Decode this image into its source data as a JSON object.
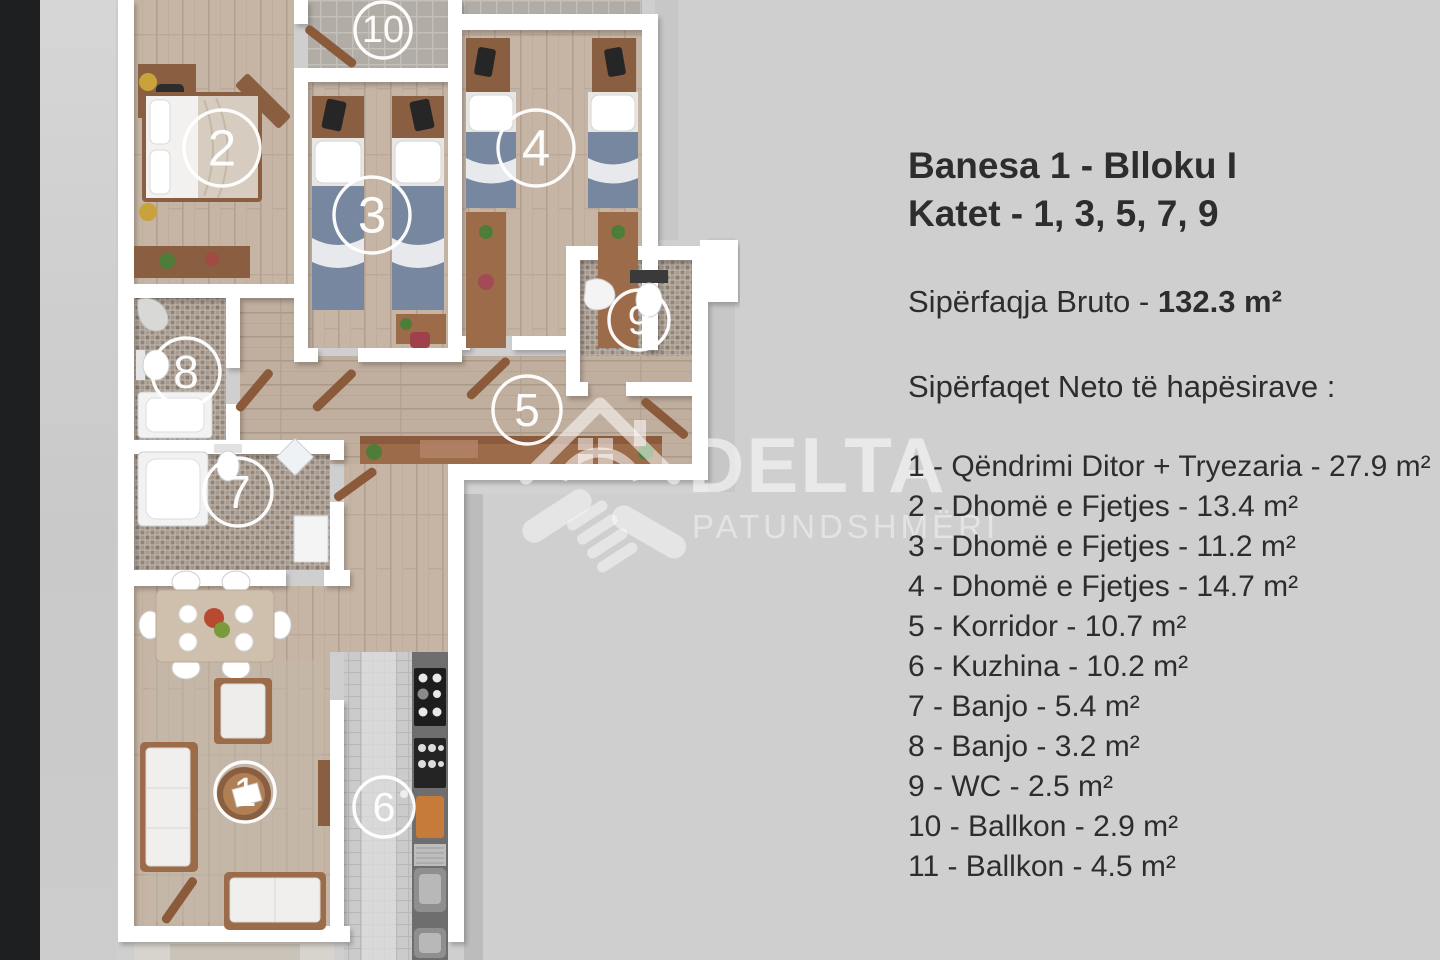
{
  "colors": {
    "background_top": "#ebebeb",
    "background_bottom": "#d8d8d8",
    "left_bar": "#1e1f20",
    "wall": "#ffffff",
    "wood_floor": "#c6b5a5",
    "bed_duvet_blue": "#76879f",
    "furniture_wood": "#8a5f41",
    "mosaic_tile": "#9b8d82",
    "kitchen_counter": "#6e6e6e",
    "panel_text": "#2d2d2d",
    "watermark": "#ffffff"
  },
  "info_panel": {
    "title_line1": "Banesa 1 - Blloku I",
    "title_line2": "Katet - 1, 3, 5, 7, 9",
    "gross_label": "Sipërfaqja Bruto - ",
    "gross_value": "132.3 m²",
    "net_heading": "Sipërfaqet Neto të hapësirave :",
    "separator": " - ",
    "rooms": [
      {
        "no": "1",
        "name": "Qëndrimi Ditor + Tryezaria",
        "area": "27.9 m²"
      },
      {
        "no": "2",
        "name": "Dhomë e Fjetjes",
        "area": "13.4 m²"
      },
      {
        "no": "3",
        "name": "Dhomë e Fjetjes",
        "area": "11.2 m²"
      },
      {
        "no": "4",
        "name": "Dhomë e Fjetjes",
        "area": "14.7 m²"
      },
      {
        "no": "5",
        "name": "Korridor",
        "area": "10.7 m²"
      },
      {
        "no": "6",
        "name": "Kuzhina",
        "area": "10.2 m²"
      },
      {
        "no": "7",
        "name": "Banjo",
        "area": "5.4 m²"
      },
      {
        "no": "8",
        "name": "Banjo",
        "area": "3.2 m²"
      },
      {
        "no": "9",
        "name": "WC",
        "area": "2.5 m²"
      },
      {
        "no": "10",
        "name": "Ballkon",
        "area": "2.9 m²"
      },
      {
        "no": "11",
        "name": "Ballkon",
        "area": "4.5 m²"
      }
    ]
  },
  "floor_plan": {
    "labels": [
      {
        "no": "10",
        "x": 383,
        "y": 30,
        "r": 28
      },
      {
        "no": "2",
        "x": 222,
        "y": 148,
        "r": 38
      },
      {
        "no": "3",
        "x": 372,
        "y": 215,
        "r": 38
      },
      {
        "no": "4",
        "x": 536,
        "y": 148,
        "r": 38
      },
      {
        "no": "9",
        "x": 639,
        "y": 320,
        "r": 30
      },
      {
        "no": "8",
        "x": 186,
        "y": 372,
        "r": 34
      },
      {
        "no": "5",
        "x": 527,
        "y": 410,
        "r": 34
      },
      {
        "no": "7",
        "x": 238,
        "y": 492,
        "r": 34
      },
      {
        "no": "1",
        "x": 245,
        "y": 792,
        "r": 30
      },
      {
        "no": "6",
        "x": 384,
        "y": 807,
        "r": 30
      }
    ]
  },
  "watermark": {
    "brand": "DELTA",
    "subtitle": "PATUNDSHMËRI"
  }
}
